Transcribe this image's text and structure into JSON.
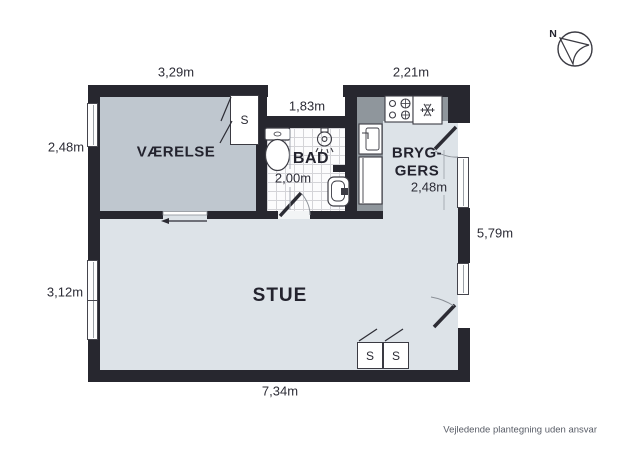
{
  "colors": {
    "wall": "#27272f",
    "vaerelse-floor": "#bfc7cf",
    "stue-floor": "#dde3e8",
    "counter": "#8f969c",
    "tile-line": "#d4d4d8",
    "room-text": "#23232e",
    "measure-text": "#2c2c36",
    "footer-text": "#585c66"
  },
  "rooms": {
    "vaerelse": "VÆRELSE",
    "bad": "BAD",
    "bryggers_line1": "BRYG-",
    "bryggers_line2": "GERS",
    "stue": "STUE"
  },
  "measurements": {
    "vaerelse_top": "3,29m",
    "bryggers_top": "2,21m",
    "niche": "1,83m",
    "vaerelse_left": "2,48m",
    "bad": "2,00m",
    "bryggers_inner": "2,48m",
    "right_side": "5,79m",
    "stue_left": "3,12m",
    "bottom": "7,34m"
  },
  "closets": {
    "vaerelse": "S",
    "stue_1": "S",
    "stue_2": "S"
  },
  "compass": {
    "label": "N"
  },
  "footer": "Vejledende plantegning uden ansvar"
}
